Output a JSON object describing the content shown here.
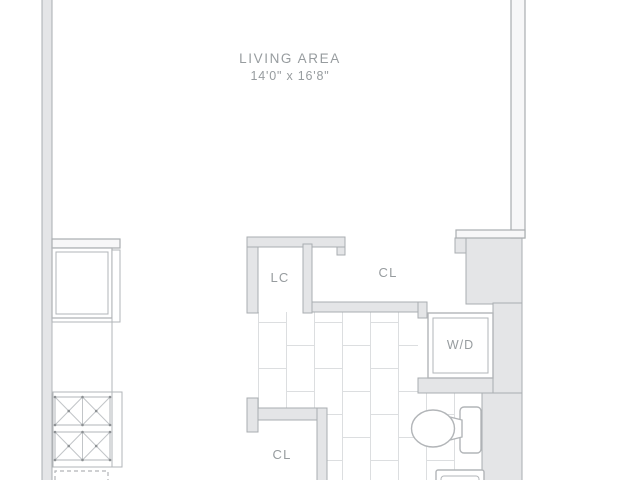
{
  "plan": {
    "type": "apartment-floor-plan",
    "rooms": {
      "living_area": {
        "label": "LIVING AREA",
        "dimensions": "14'0\" x 16'8\""
      },
      "linen_closet": {
        "label": "LC"
      },
      "closet_upper": {
        "label": "CL"
      },
      "washer_dryer": {
        "label": "W/D"
      },
      "closet_lower": {
        "label": "CL"
      }
    },
    "colors": {
      "background": "#ffffff",
      "wall_fill": "#e4e5e7",
      "wall_hollow_fill": "#f7f7f8",
      "wall_line": "#a9adb0",
      "fixture_line": "#b2b5b8",
      "tile_line": "#dcdee0",
      "label_text": "#979c9f"
    }
  }
}
